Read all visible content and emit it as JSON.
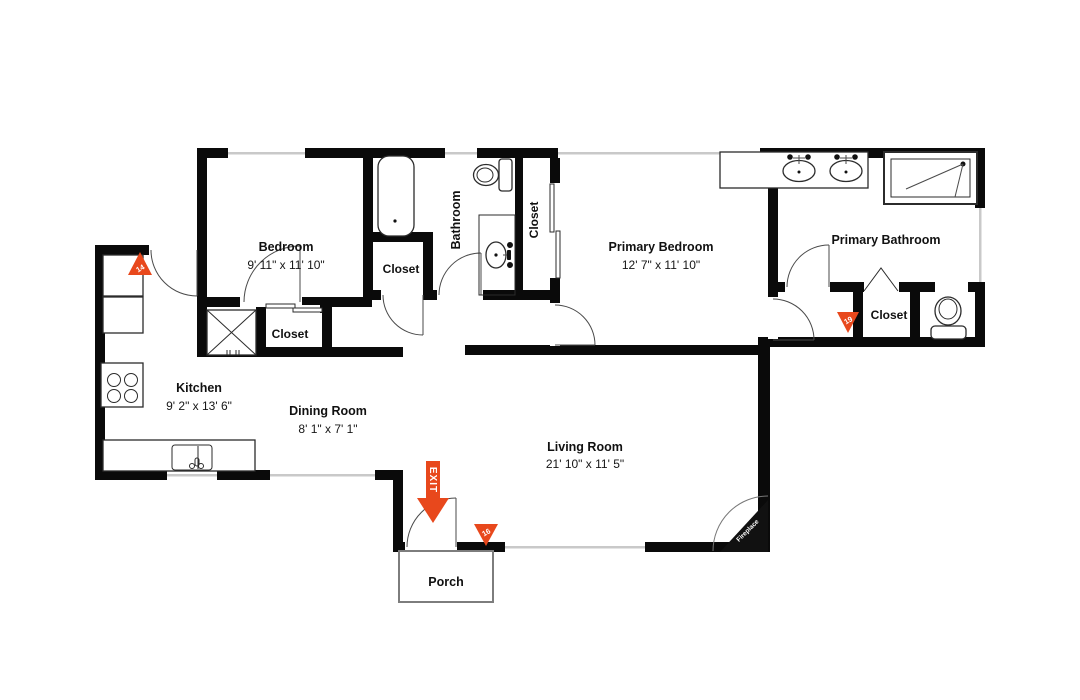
{
  "rooms": {
    "bedroom": {
      "name": "Bedroom",
      "dims": "9' 11\" x 11' 10\""
    },
    "bathroom": {
      "name": "Bathroom"
    },
    "bathroom_closet": {
      "name": "Closet"
    },
    "bedroom_closet": {
      "name": "Closet"
    },
    "hall_closet": {
      "name": "Closet"
    },
    "primary_bedroom": {
      "name": "Primary Bedroom",
      "dims": "12' 7\" x 11' 10\""
    },
    "primary_bathroom": {
      "name": "Primary Bathroom"
    },
    "primary_closet": {
      "name": "Closet"
    },
    "kitchen": {
      "name": "Kitchen",
      "dims": "9' 2\" x 13' 6\""
    },
    "dining_room": {
      "name": "Dining Room",
      "dims": "8' 1\" x 7' 1\""
    },
    "living_room": {
      "name": "Living Room",
      "dims": "21' 10\" x 11' 5\""
    },
    "porch": {
      "name": "Porch"
    }
  },
  "annotations": {
    "fireplace": "Fireplace",
    "exit": "EXIT"
  },
  "markers": {
    "kitchen": "14",
    "primary_hall": "19",
    "living_room": "16"
  },
  "colors": {
    "wall": "#0a0a0a",
    "accent": "#e8481c",
    "window_line": "#c9c9c9"
  }
}
